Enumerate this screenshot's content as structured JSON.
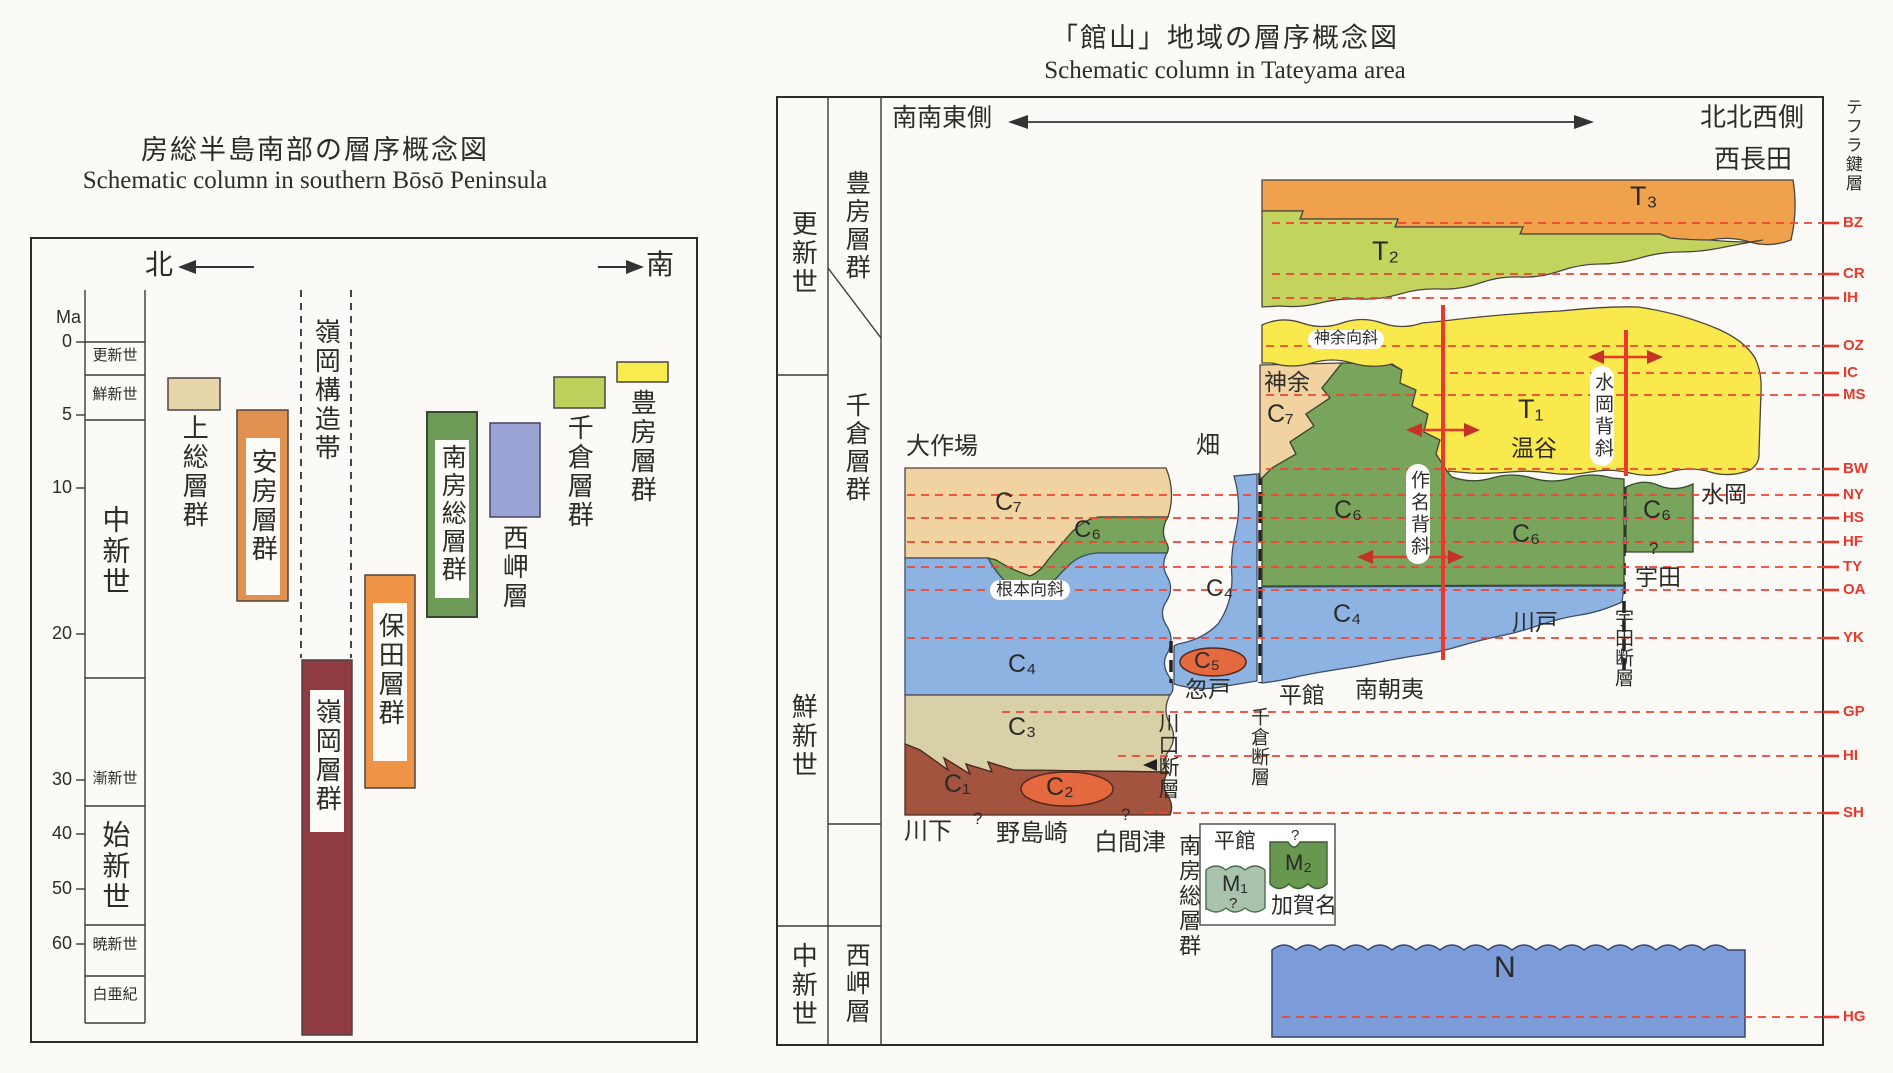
{
  "left": {
    "title_ja": "房総半島南部の層序概念図",
    "title_en": "Schematic column in southern Bōsō Peninsula",
    "north": "北",
    "south": "南",
    "axis_unit": "Ma",
    "ticks": [
      "0",
      "5",
      "10",
      "20",
      "30",
      "40",
      "50",
      "60"
    ],
    "epochs": [
      "更新世",
      "鮮新世",
      "中新世",
      "漸新世",
      "始新世",
      "暁新世",
      "白亜紀"
    ],
    "tectonic_belt": "嶺岡構造帯",
    "bars": [
      {
        "label": "上総層群",
        "color": "#e7d6ab"
      },
      {
        "label": "安房層群",
        "color": "#e1914f"
      },
      {
        "label": "嶺岡層群",
        "color": "#8e3b42"
      },
      {
        "label": "保田層群",
        "color": "#ef9447"
      },
      {
        "label": "南房総層群",
        "color": "#6e9b58"
      },
      {
        "label": "西岬層",
        "color": "#9aa3d4"
      },
      {
        "label": "千倉層群",
        "color": "#bdd05c"
      },
      {
        "label": "豊房層群",
        "color": "#f7eb4e"
      }
    ]
  },
  "right": {
    "title_ja": "「館山」地域の層序概念図",
    "title_en": "Schematic column in Tateyama area",
    "sse": "南南東側",
    "nnw": "北北西側",
    "tephra_col": "テフラ鍵層",
    "epochs": [
      "更新世",
      "鮮新世",
      "中新世"
    ],
    "groups": [
      "豊房層群",
      "千倉層群",
      "西岬層"
    ],
    "tephra": [
      "BZ",
      "CR",
      "IH",
      "OZ",
      "IC",
      "MS",
      "BW",
      "NY",
      "HS",
      "HF",
      "TY",
      "OA",
      "YK",
      "GP",
      "HI",
      "SH",
      "HG"
    ],
    "units": {
      "t3": "T₃",
      "t2": "T₂",
      "t1": "T₁",
      "c7": "C₇",
      "c6": "C₆",
      "c5": "C₅",
      "c4": "C₄",
      "c3": "C₃",
      "c2": "C₂",
      "c1": "C₁",
      "n": "N",
      "m1": "M₁",
      "m2": "M₂"
    },
    "places": {
      "daisakuba": "大作場",
      "hata": "畑",
      "nishinagata": "西長田",
      "kanamari": "神余",
      "nukutani": "温谷",
      "mizuoka": "水岡",
      "uda": "宇田",
      "kawado": "川戸",
      "minamiasai": "南朝夷",
      "tatakiyakata": "平館",
      "kotto": "忽戸",
      "kawashimo": "川下",
      "nojimazaki": "野島崎",
      "shiramazu": "白間津",
      "kagana": "加賀名"
    },
    "structures": {
      "kanamari_syncline": "神余向斜",
      "nemoto_syncline": "根本向斜",
      "sakuna_anticline": "作名背斜",
      "mizuoka_anticline": "水岡背斜",
      "chikura_fault": "千倉断層",
      "uda_fault": "宇田断層",
      "kawaguchi_fault": "川口断層",
      "minamiboso_group": "南房総層群"
    },
    "q": "?"
  }
}
